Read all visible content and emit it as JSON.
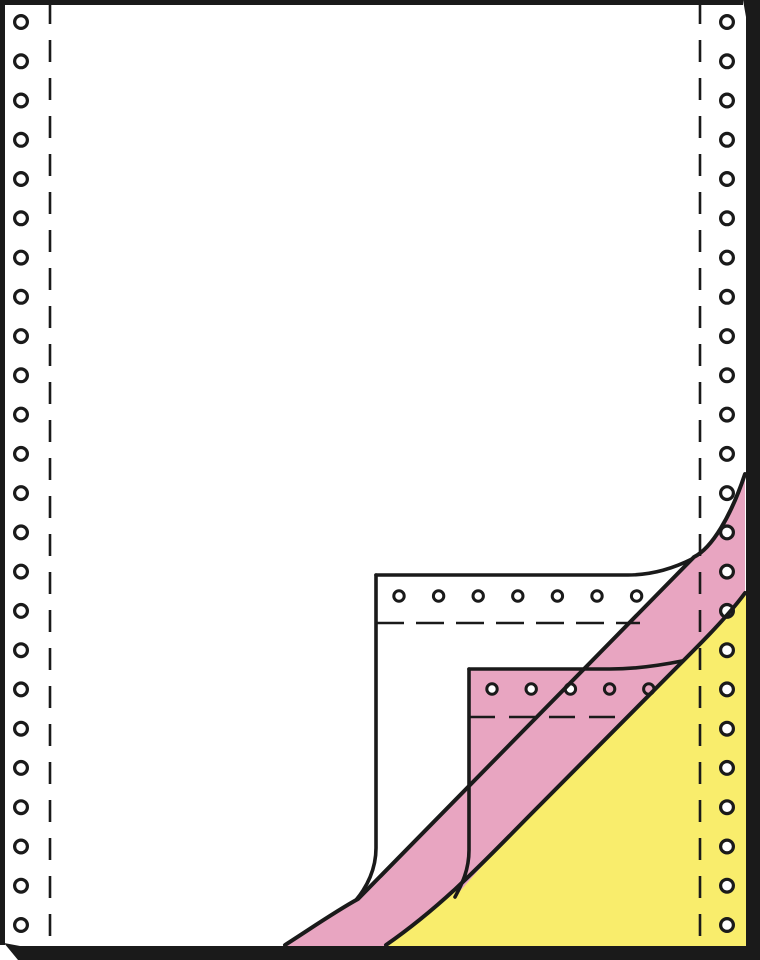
{
  "illustration": {
    "subject": "continuous-form-paper-3-ply",
    "plies": [
      "white-original",
      "pink-copy",
      "yellow-copy"
    ],
    "visible_text": ""
  },
  "colors": {
    "page_white": "#ffffff",
    "pink": "#e8a5c1",
    "yellow": "#f9ed6c",
    "line": "#1a1a1a",
    "hole_white": "#ffffff"
  },
  "holes": {
    "left_column": {
      "cx": 21,
      "y_start": 22,
      "y_step": 39.26,
      "count": 24,
      "r": 6.4,
      "ring": 3.2,
      "ring_color": "#1a1a1a",
      "fill": "#ffffff"
    },
    "right_column": {
      "cx": 727,
      "y_start": 22,
      "y_step": 39.26,
      "count": 24,
      "r": 6.4,
      "ring": 3.2,
      "ring_color": "#1a1a1a",
      "fill": "#ffffff"
    },
    "white_strip": {
      "cy": 596,
      "x_start": 399,
      "x_step": 39.6,
      "count": 7,
      "r": 5.2,
      "ring": 3.0,
      "ring_color": "#1a1a1a",
      "fill": "#ffffff"
    },
    "pink_strip": {
      "cy": 689,
      "x_start": 492,
      "x_step": 39.2,
      "count": 5,
      "r": 5.2,
      "ring": 3.0,
      "ring_color": "#1a1a1a",
      "fill": "#ffffff",
      "fills": [
        "#ffffff",
        "#ffffff",
        "#ffffff",
        "#e8a5c1",
        "#e8a5c1"
      ]
    }
  },
  "counts": {
    "left_holes": 24,
    "right_holes": 24,
    "white_strip_holes": 7,
    "pink_strip_holes": 5
  }
}
